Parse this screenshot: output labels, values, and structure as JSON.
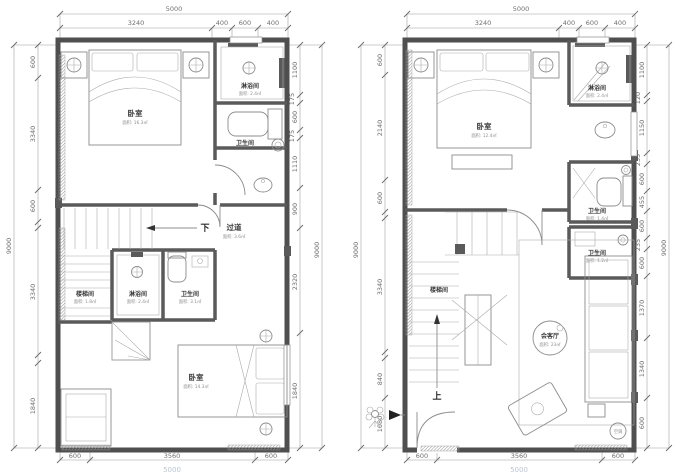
{
  "plans": {
    "left": {
      "dims": {
        "top_overall": "5000",
        "top_segs": [
          "3240",
          "400",
          "600",
          "400"
        ],
        "left_overall": "9000",
        "left_segs": [
          "600",
          "3340",
          "600",
          "3340",
          "1840"
        ],
        "right_overall": "9000",
        "right_segs": [
          "1100",
          "175",
          "600",
          "175",
          "1110",
          "900",
          "2320",
          "1840"
        ],
        "bottom_segs": [
          "600",
          "3560",
          "600"
        ],
        "bottom_cut": "5000"
      },
      "labels": {
        "bedroom_top": {
          "name": "卧室",
          "area": "面积: 16.3㎡"
        },
        "shower_top": {
          "name": "淋浴间",
          "area": "面积: 2.4㎡"
        },
        "wc_top": {
          "name": "卫生间",
          "area": "面积: 2.1㎡"
        },
        "down": "下",
        "corridor": {
          "name": "过道",
          "area": "面积: 3.6㎡"
        },
        "stairwell": {
          "name": "楼梯间",
          "area": "面积: 1.8㎡"
        },
        "shower_mid": {
          "name": "淋浴间",
          "area": "面积: 2.4㎡"
        },
        "wc_mid": {
          "name": "卫生间",
          "area": "面积: 3.1㎡"
        },
        "bedroom_bottom": {
          "name": "卧室",
          "area": "面积: 14.3㎡"
        }
      }
    },
    "right": {
      "dims": {
        "top_overall": "5000",
        "top_segs": [
          "3240",
          "400",
          "600",
          "400"
        ],
        "left_overall": "9000",
        "left_segs": [
          "600",
          "2140",
          "600",
          "3340",
          "840",
          "1080"
        ],
        "right_overall": "9000",
        "right_segs": [
          "1100",
          "120",
          "1150",
          "235",
          "600",
          "455",
          "600",
          "235",
          "600",
          "1370",
          "1340",
          "600"
        ],
        "bottom_segs": [
          "600",
          "3560",
          "600"
        ],
        "bottom_cut": "5000"
      },
      "labels": {
        "bedroom": {
          "name": "卧室",
          "area": "面积: 12.4㎡"
        },
        "shower": {
          "name": "淋浴间",
          "area": "面积: 2.4㎡"
        },
        "wc_upper": {
          "name": "卫生间",
          "area": "面积: 1.4㎡"
        },
        "wc_lower": {
          "name": "卫生间",
          "area": "面积: 1.2㎡"
        },
        "stairwell": {
          "name": "楼梯间"
        },
        "up": "上",
        "living": {
          "name": "会客厅",
          "area": "面积: 23㎡"
        },
        "ac": "空调"
      }
    }
  }
}
